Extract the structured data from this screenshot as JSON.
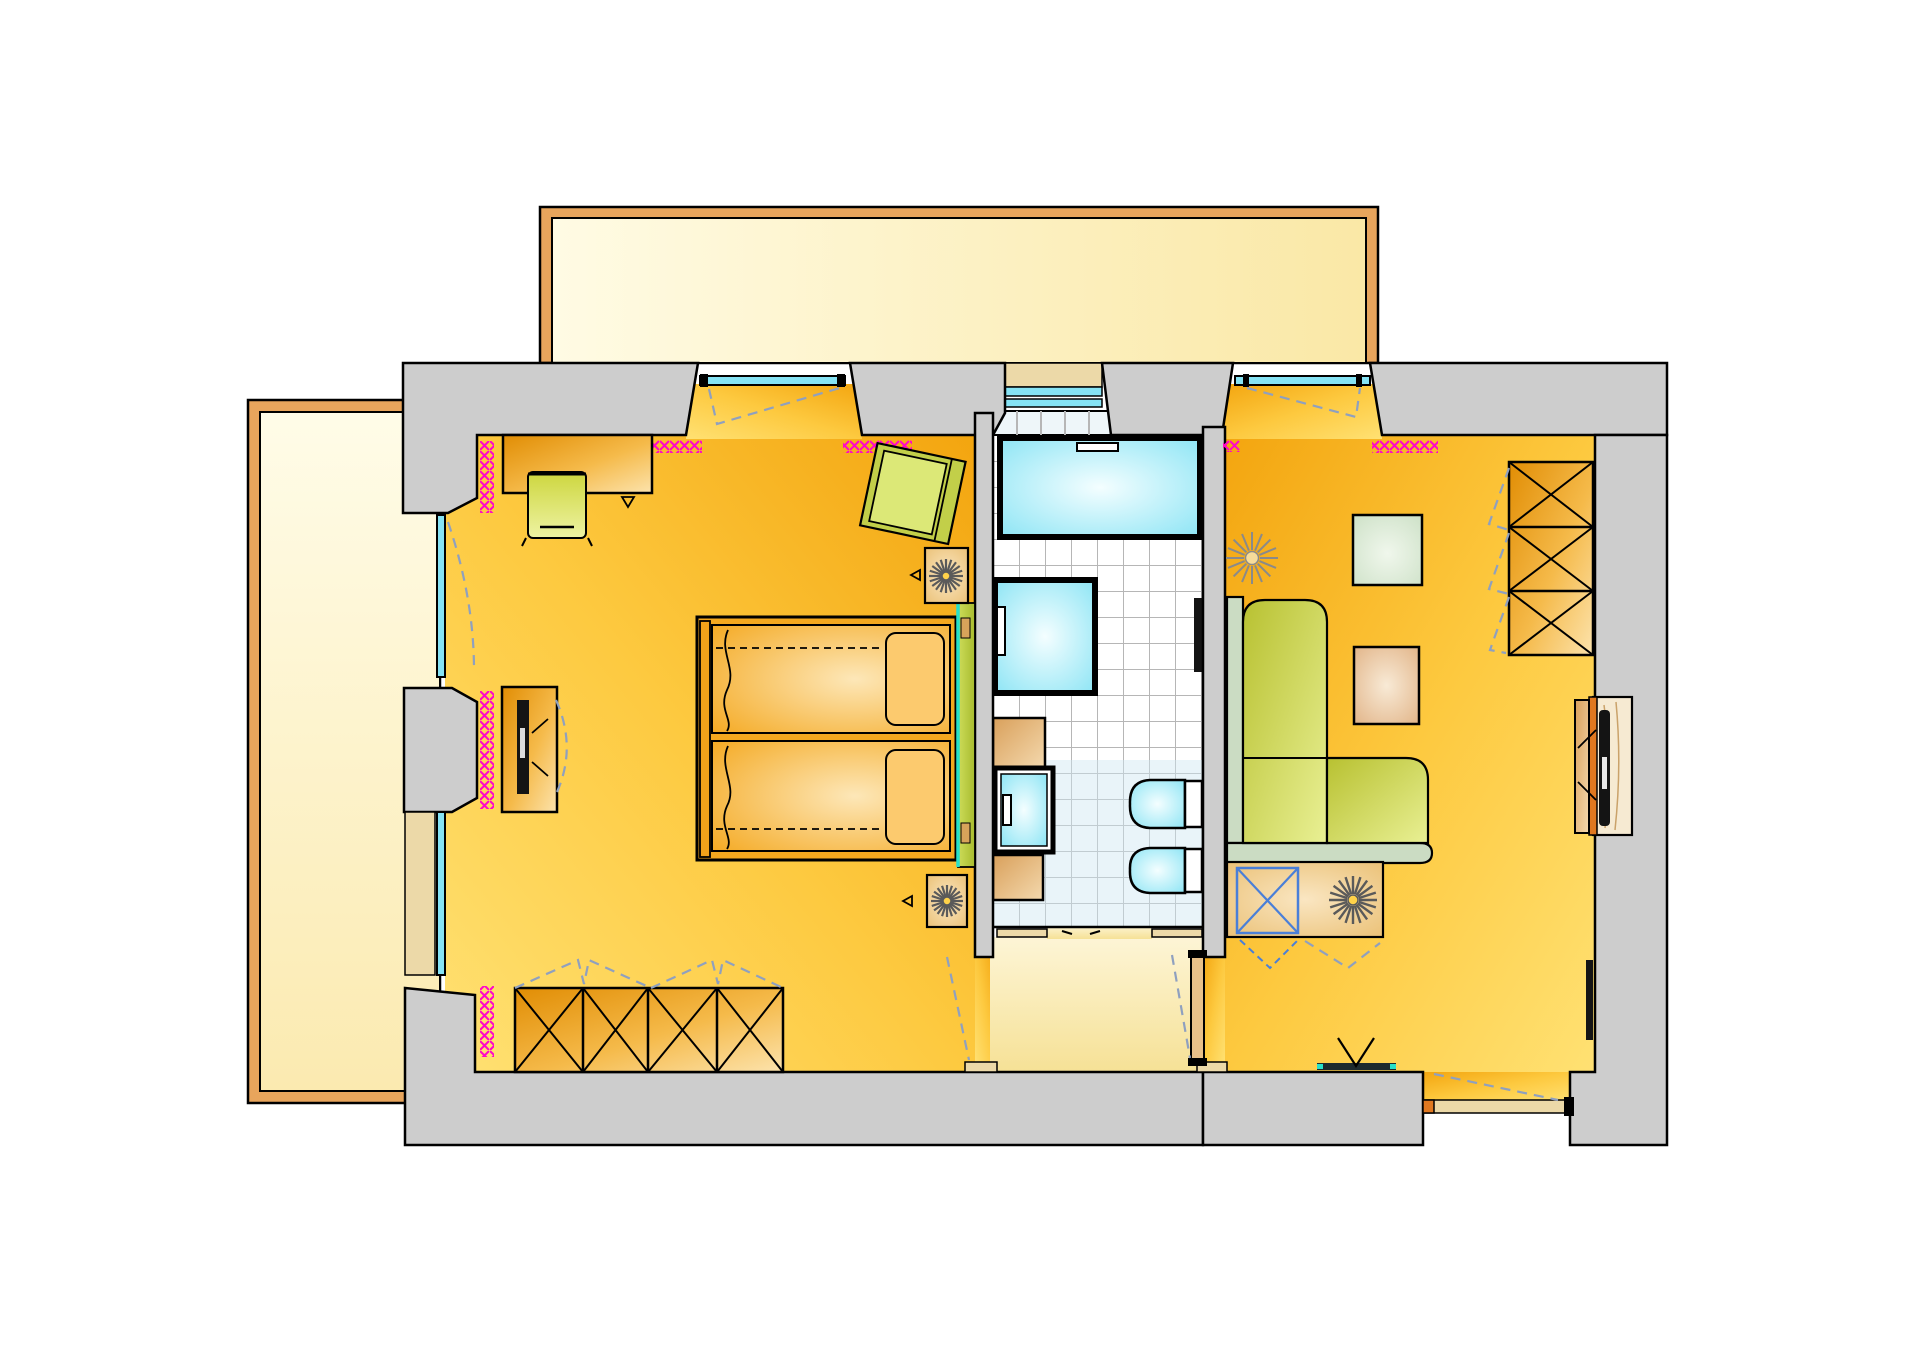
{
  "document": {
    "type": "architectural floor plan",
    "view": "top-down apartment plan",
    "visible_text": "none"
  },
  "rooms": [
    {
      "id": "bedroom",
      "label": "Bedroom",
      "floor": "yellow-orange"
    },
    {
      "id": "bathroom",
      "label": "Bathroom",
      "floor": "white tiles"
    },
    {
      "id": "living-room",
      "label": "Living room",
      "floor": "yellow-orange"
    },
    {
      "id": "entrance-hall",
      "label": "Entrance hall",
      "floor": "cream"
    },
    {
      "id": "balcony-top",
      "label": "Upper balcony",
      "floor": "pale yellow"
    },
    {
      "id": "balcony-left",
      "label": "Side balcony",
      "floor": "pale yellow"
    }
  ],
  "furniture": {
    "bedroom": [
      "desk",
      "desk chair",
      "rotated armchair",
      "double bed with two mattresses and two pillows",
      "green headboard bench",
      "tv sideboard with television",
      "wardrobe with 4 cross-marked doors",
      "two fan units with direction triangles"
    ],
    "bathroom": [
      "bathtub with faucet",
      "shower cabin with handle",
      "washbasin with two counters",
      "toilet",
      "bidet",
      "towel bar"
    ],
    "living-room": [
      "L-shaped corner sofa",
      "square side table green",
      "square side table tan",
      "sunburst ceiling light symbol",
      "wardrobe with 3 cross-marked doors",
      "recessed tv cabinet with television",
      "corner cabinet with blue cross door and fan",
      "wall bar with V symbol"
    ],
    "entrance-hall": [
      "door leaf to living room",
      "dashed door swings"
    ]
  },
  "symbols": {
    "radiator": "magenta cross-hatch strip",
    "window": "cyan double line",
    "door_swing": "blue-gray dashed line",
    "glass_water": "cyan radial fill"
  },
  "counts": {
    "bedroom_wardrobe_doors": 4,
    "living_wardrobe_doors": 3,
    "radiator_strips": 7,
    "fan_rosettes": 3,
    "sunbursts": 1
  },
  "palette": {
    "wall": "#cdcdcd",
    "balconyBorder": "#e8a55c",
    "balTopA": "#fffbe4",
    "balTopB": "#fae8a6",
    "balLeftA": "#fffce8",
    "balLeftB": "#fbeab0",
    "roomA": "#ffe173",
    "roomB": "#fdc93f",
    "roomC": "#f3a50f",
    "hallA": "#fdf5d6",
    "hallB": "#f6e196",
    "tileGrout": "#b6b6b6",
    "tileTint": "#cfe7f2",
    "glassEdge": "#86e3f4",
    "glassCenter": "#f4feff",
    "woodDark": "#e18d04",
    "woodMid": "#f5ba4a",
    "woodLight": "#fce3ad",
    "counterA": "#d9a05b",
    "counterB": "#f4d9ae",
    "mattEdge": "#f4a81f",
    "mattCenter": "#fde7b8",
    "pillow": "#fcca6e",
    "sofaSeatA": "#b8c131",
    "sofaSeatB": "#e9f094",
    "sofaBack": "#cbdcc3",
    "benchA": "#cddc5a",
    "benchB": "#a8bc2e",
    "tableGreenA": "#f0f7ec",
    "tableGreenB": "#cfe2c9",
    "tableTanA": "#f8ead6",
    "tableTanB": "#e2b589",
    "radiator": "#ff08c8",
    "dashBlue": "#8fa0bf",
    "blueX": "#4a7fd8",
    "fanGray": "#5a5a5a",
    "sunGray": "#8a8a8a",
    "turquoise": "#28e0c8",
    "tvBlack": "#141414",
    "nicheWood": "#f6ead2",
    "orangeStrip": "#e07820",
    "beige": "#ecd9a8",
    "stepTile": "#eef6f9"
  }
}
